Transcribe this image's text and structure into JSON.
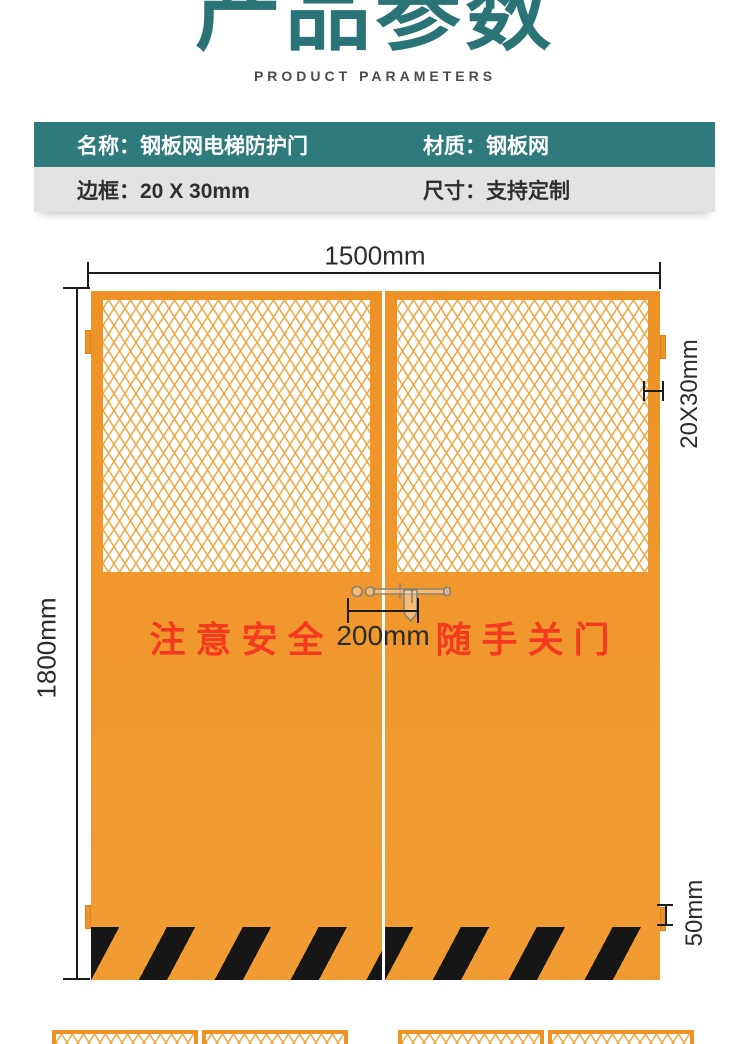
{
  "header": {
    "title": "产品参数",
    "subtitle": "PRODUCT PARAMETERS"
  },
  "spec_table": {
    "rows": [
      {
        "cells": [
          {
            "label": "名称：",
            "value": "钢板网电梯防护门"
          },
          {
            "label": "材质：",
            "value": "钢板网"
          }
        ]
      },
      {
        "cells": [
          {
            "label": "边框：",
            "value": "20 X 30mm"
          },
          {
            "label": "尺寸：",
            "value": "支持定制"
          }
        ]
      }
    ]
  },
  "diagram": {
    "dim_width": "1500mm",
    "dim_height": "1800mm",
    "dim_frame": "20X30mm",
    "dim_handle_gap": "200mm",
    "dim_bottom_rail": "50mm",
    "left_door_slogan": "注 意 安 全",
    "right_door_slogan": "随 手 关 门"
  },
  "colors": {
    "brand_teal": "#2E7A7D",
    "title_teal": "#2A7478",
    "row_gray": "#E3E3E4",
    "door_orange": "#F0982E",
    "mesh_line_orange": "#F0A53E",
    "warning_red": "#F5391F",
    "stripe_black": "#161616",
    "dim_line_black": "#1C1C1C"
  }
}
